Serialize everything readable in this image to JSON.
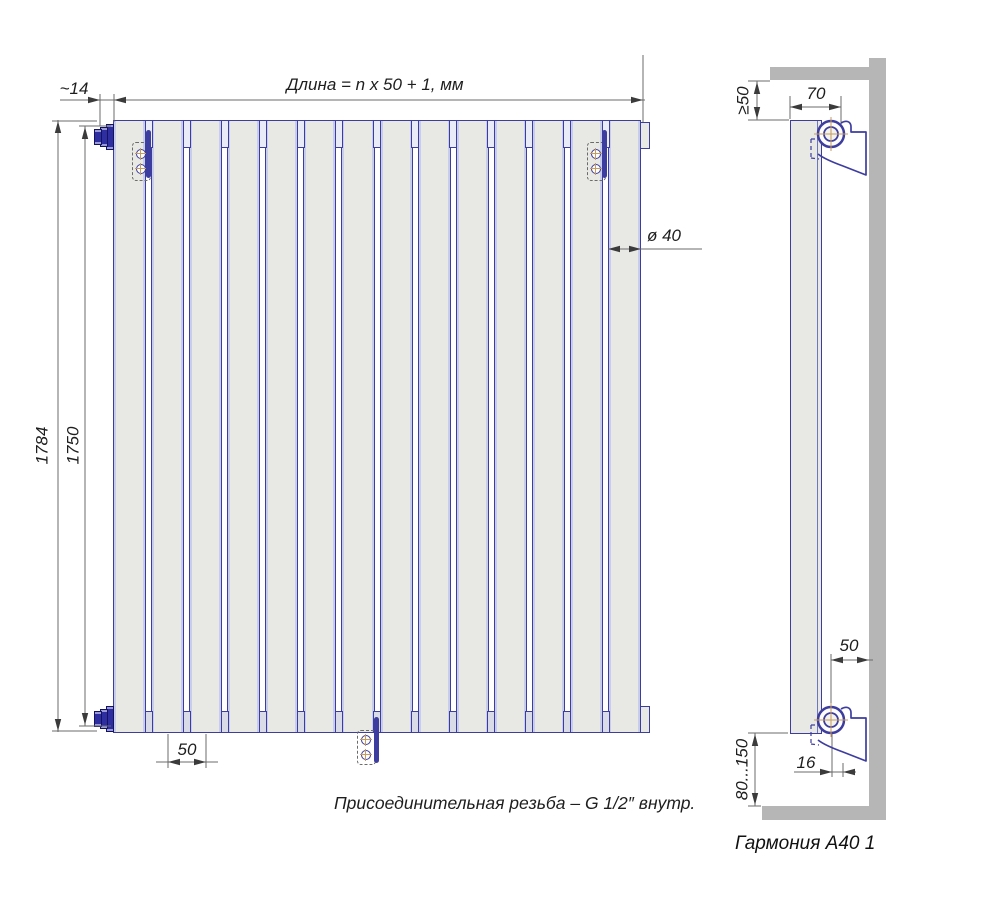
{
  "front_view": {
    "section_count": 14,
    "length_formula": "Длина = n x 50 + 1, мм",
    "side_offset": "~14",
    "total_height": "1784",
    "tube_height": "1750",
    "tube_diameter": "ø 40",
    "tube_pitch": "50",
    "thread_note": "Присоединительная резьба – G 1/2″ внутр."
  },
  "side_view": {
    "min_top_clearance": "≥50",
    "top_wall_offset": "70",
    "bottom_wall_offset": "50",
    "axis_to_face_offset": "16",
    "floor_clearance": "80...150"
  },
  "title": "Гармония А40 1",
  "colors": {
    "radiator_outline": "#3d3da0",
    "radiator_fill": "#e8e8e5",
    "collector_fill": "#e9ebf8",
    "valve_fill": "#2e2ea0",
    "wall_gray": "#b6b6b6",
    "dimension_line": "#6b6b6b",
    "centerline_tan": "#c89b5e",
    "text": "#1e1e1e"
  }
}
